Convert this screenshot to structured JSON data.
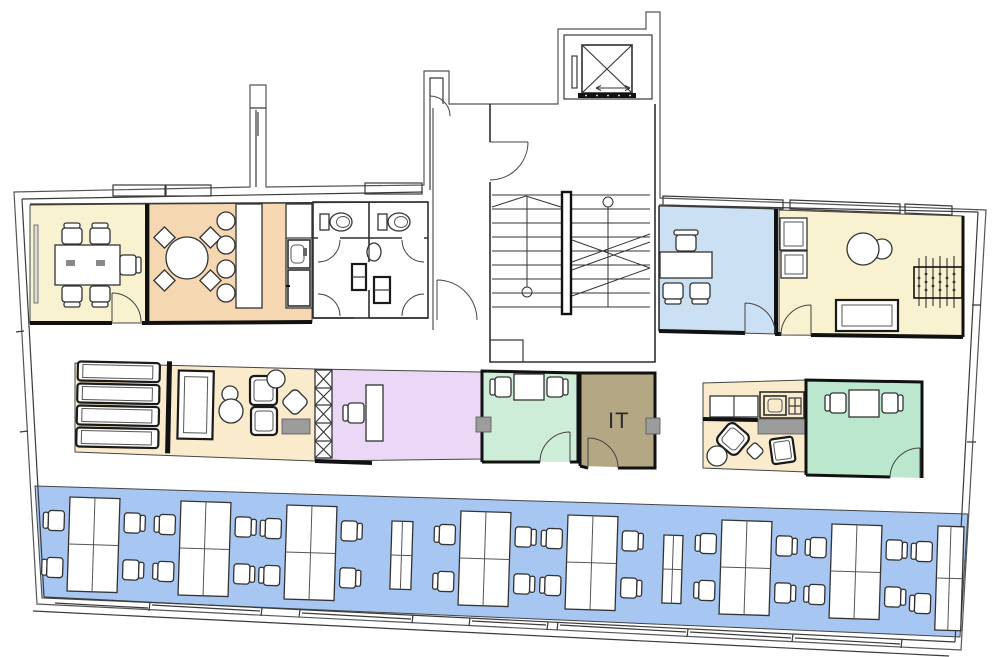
{
  "labels": {
    "it_room": "IT"
  },
  "colors": {
    "room_yellow": "#F9F2D0",
    "room_peach": "#F5D7B2",
    "room_blue": "#CCE0F4",
    "room_cream": "#FAEBCD",
    "room_purple": "#EAD8F6",
    "room_green_light": "#CDEDD8",
    "room_green": "#BCE7CF",
    "room_taupe": "#B4A784",
    "open_office_blue": "#A7C6F2",
    "accent_gray": "#9C9C9C"
  }
}
